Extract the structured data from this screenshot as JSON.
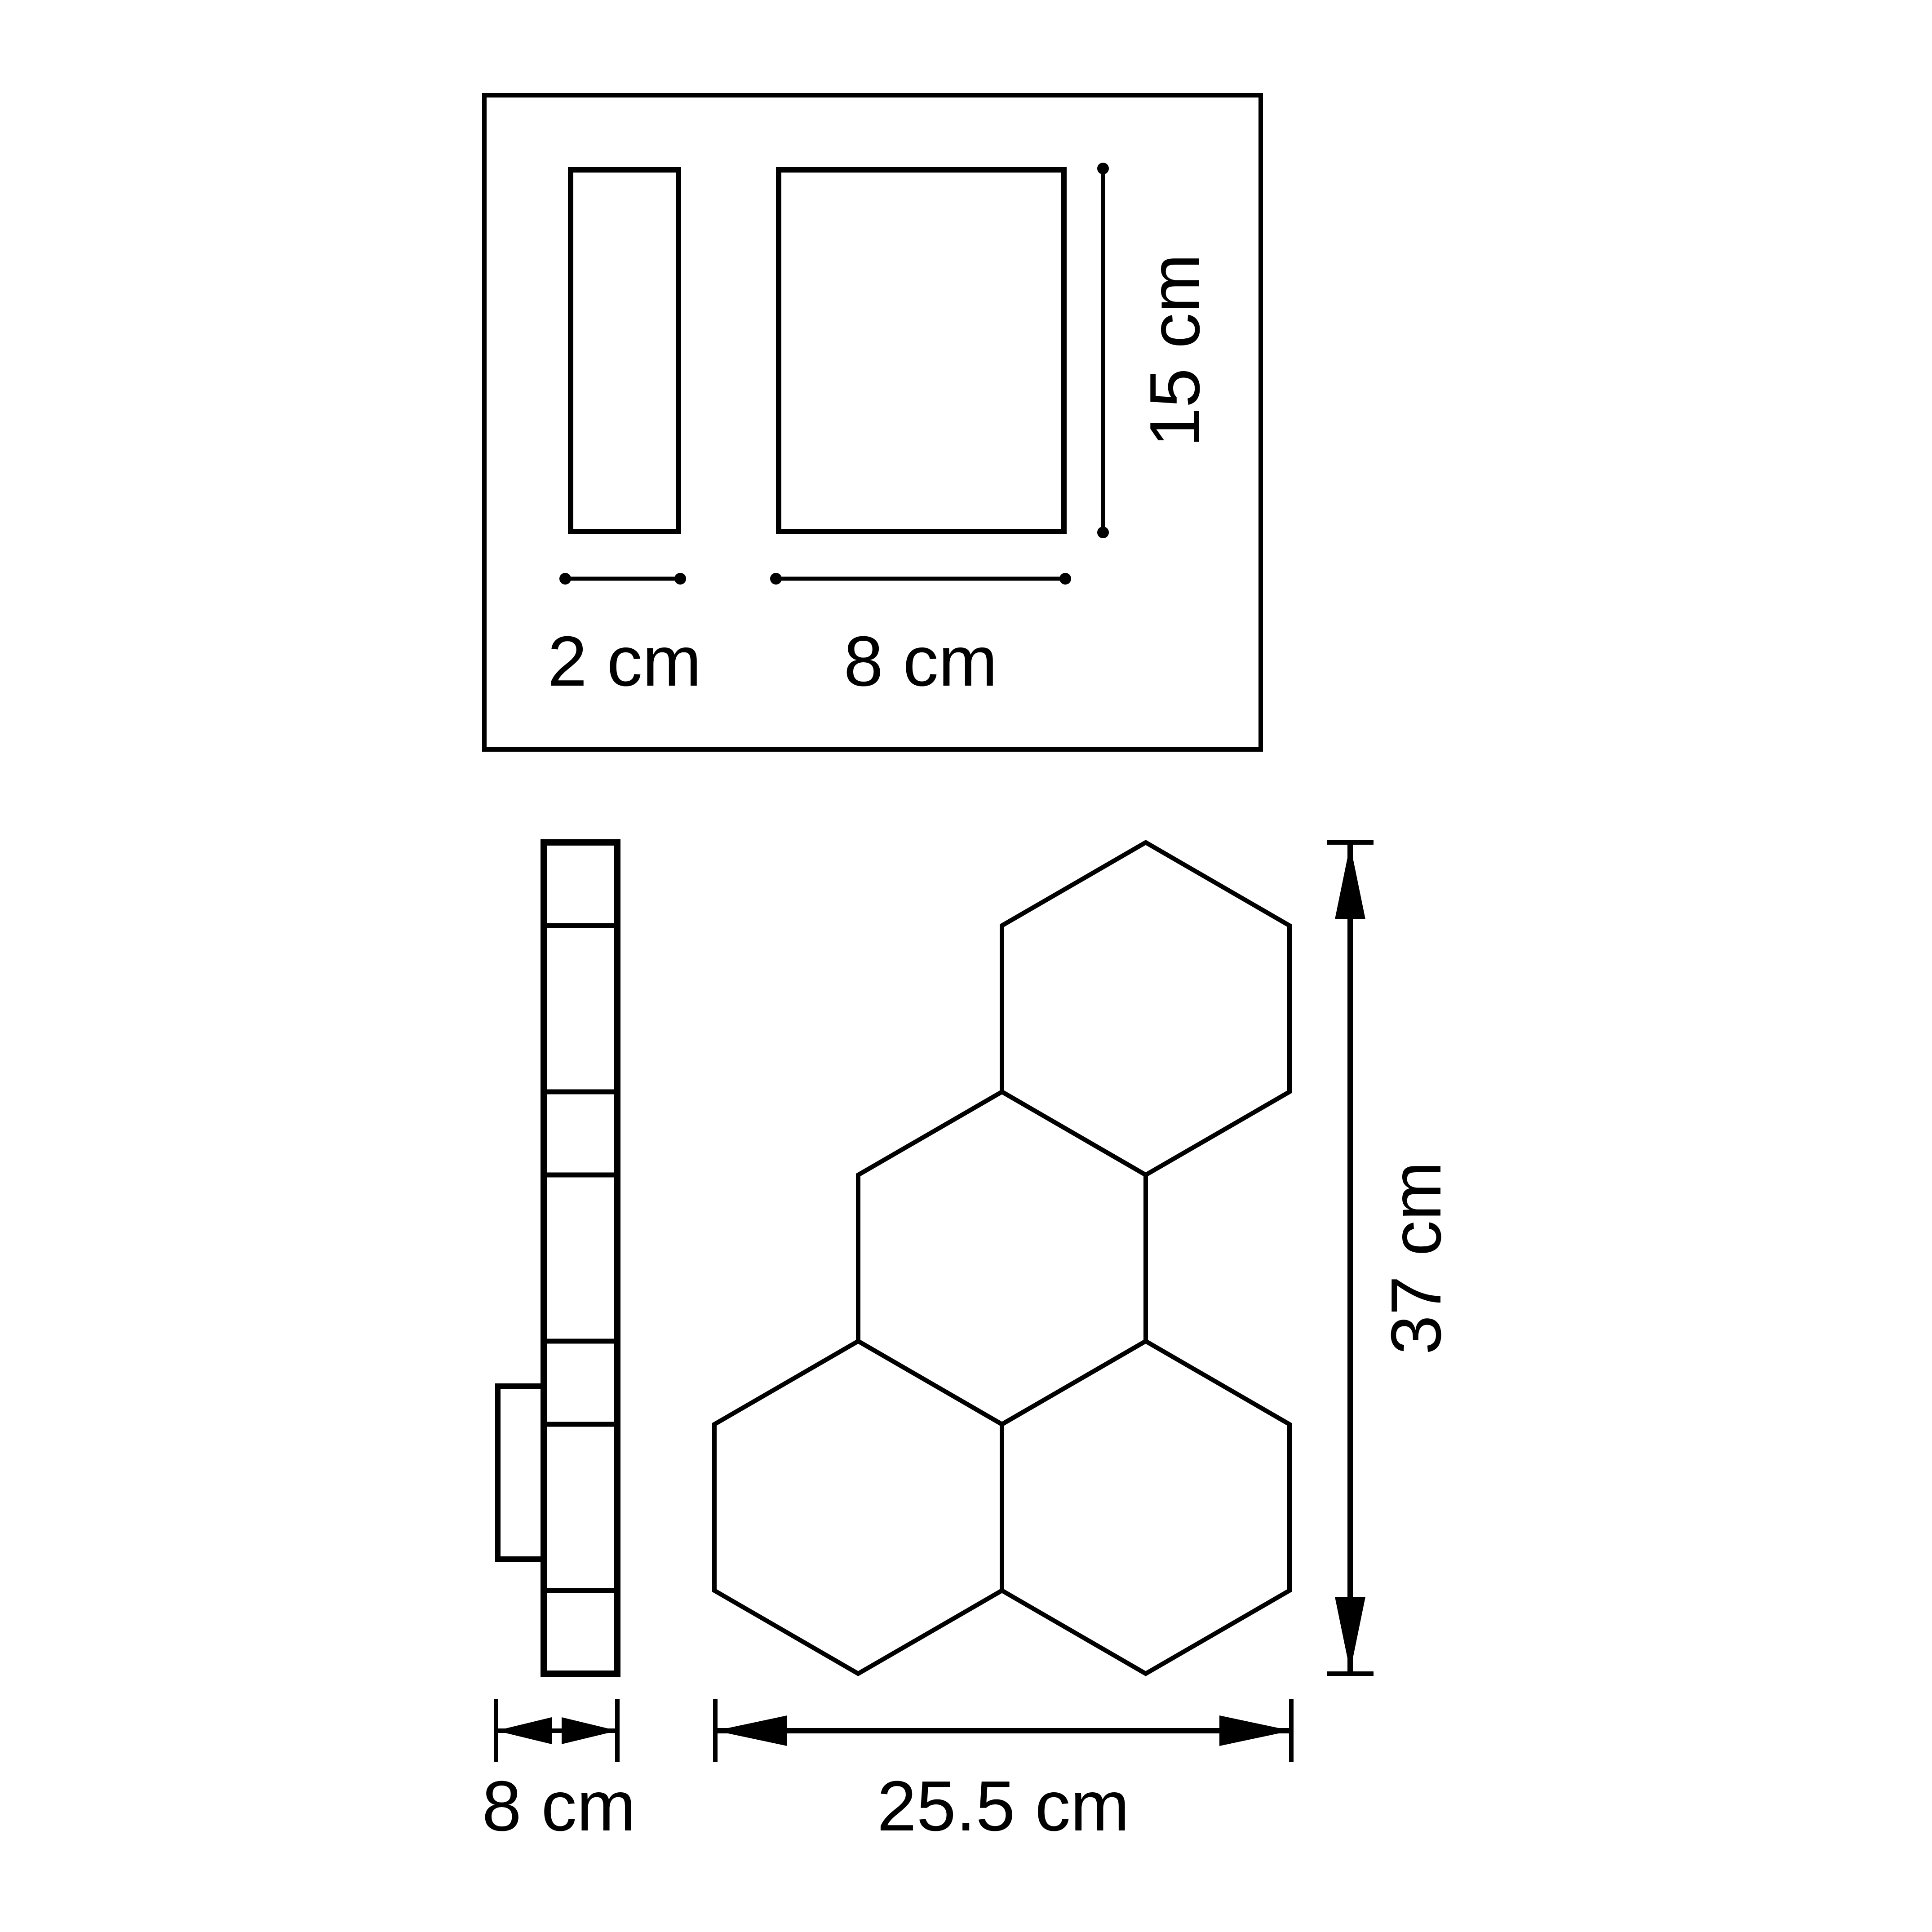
{
  "drawing": {
    "kind": "technical dimension drawing of modular hexagonal wall light",
    "colors": {
      "line": "#000000",
      "background": "#ffffff"
    },
    "detail_box": {
      "side_width_label": "2 cm",
      "front_width_label": "8 cm",
      "height_label": "15 cm"
    },
    "side_view": {
      "depth_label": "8 cm"
    },
    "front_view": {
      "width_label": "25.5 cm",
      "height_label": "37 cm"
    }
  }
}
